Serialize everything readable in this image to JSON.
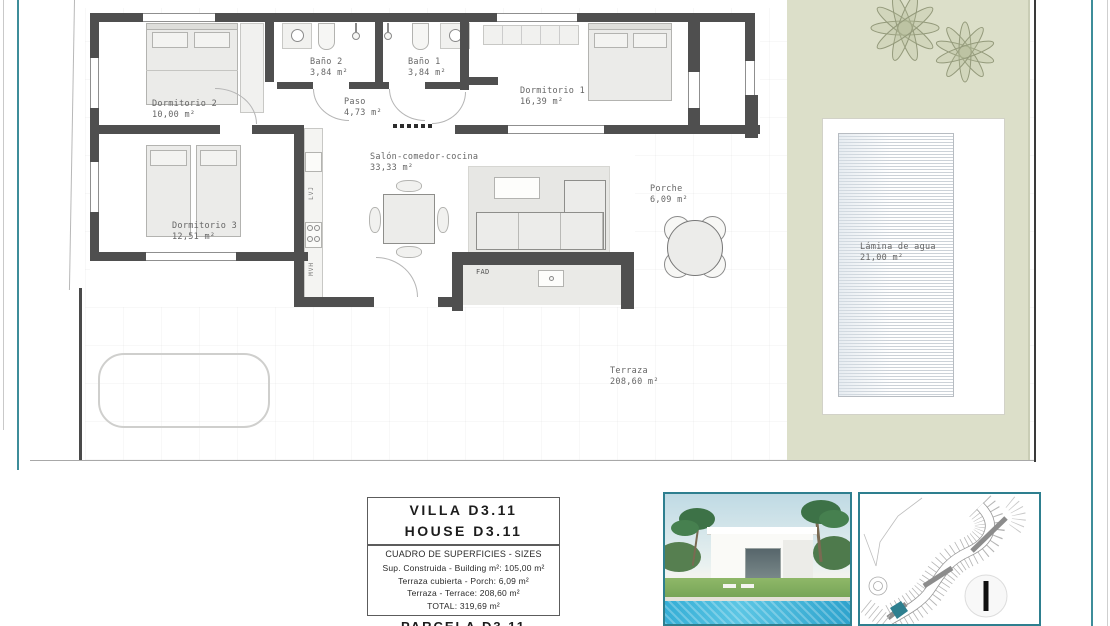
{
  "plan": {
    "rooms": [
      {
        "name": "Dormitorio 2",
        "area": "10,00 m²"
      },
      {
        "name": "Dormitorio 3",
        "area": "12,51 m²"
      },
      {
        "name": "Baño 2",
        "area": "3,84 m²"
      },
      {
        "name": "Baño 1",
        "area": "3,84 m²"
      },
      {
        "name": "Paso",
        "area": "4,73 m²"
      },
      {
        "name": "Dormitorio 1",
        "area": "16,39 m²"
      },
      {
        "name": "Salón-comedor-cocina",
        "area": "33,33 m²"
      },
      {
        "name": "Porche",
        "area": "6,09 m²"
      },
      {
        "name": "Terraza",
        "area": "208,60 m²"
      },
      {
        "name": "Lámina de agua",
        "area": "21,00 m²"
      }
    ],
    "fixture_labels": {
      "dishwasher": "LVJ",
      "micro_oven": "MVH",
      "tv_unit": "FAD"
    }
  },
  "title_block": {
    "villa": "VILLA D3.11",
    "house": "HOUSE D3.11",
    "table": [
      "CUADRO DE SUPERFICIES  -  SIZES",
      "Sup. Construida  -  Building m²:  105,00 m²",
      "Terraza cubierta  -  Porch:  6,09 m²",
      "Terraza  -  Terrace:  208,60 m²",
      "TOTAL:   319,69 m²"
    ],
    "clipped_bottom_text": "PARCELA D3.11"
  },
  "colors": {
    "frame_teal": "#2e7f8f",
    "garden_green": "#dcdfc9",
    "wall_gray": "#4f4f4f",
    "boundary_teal": "#3d8d9a"
  }
}
